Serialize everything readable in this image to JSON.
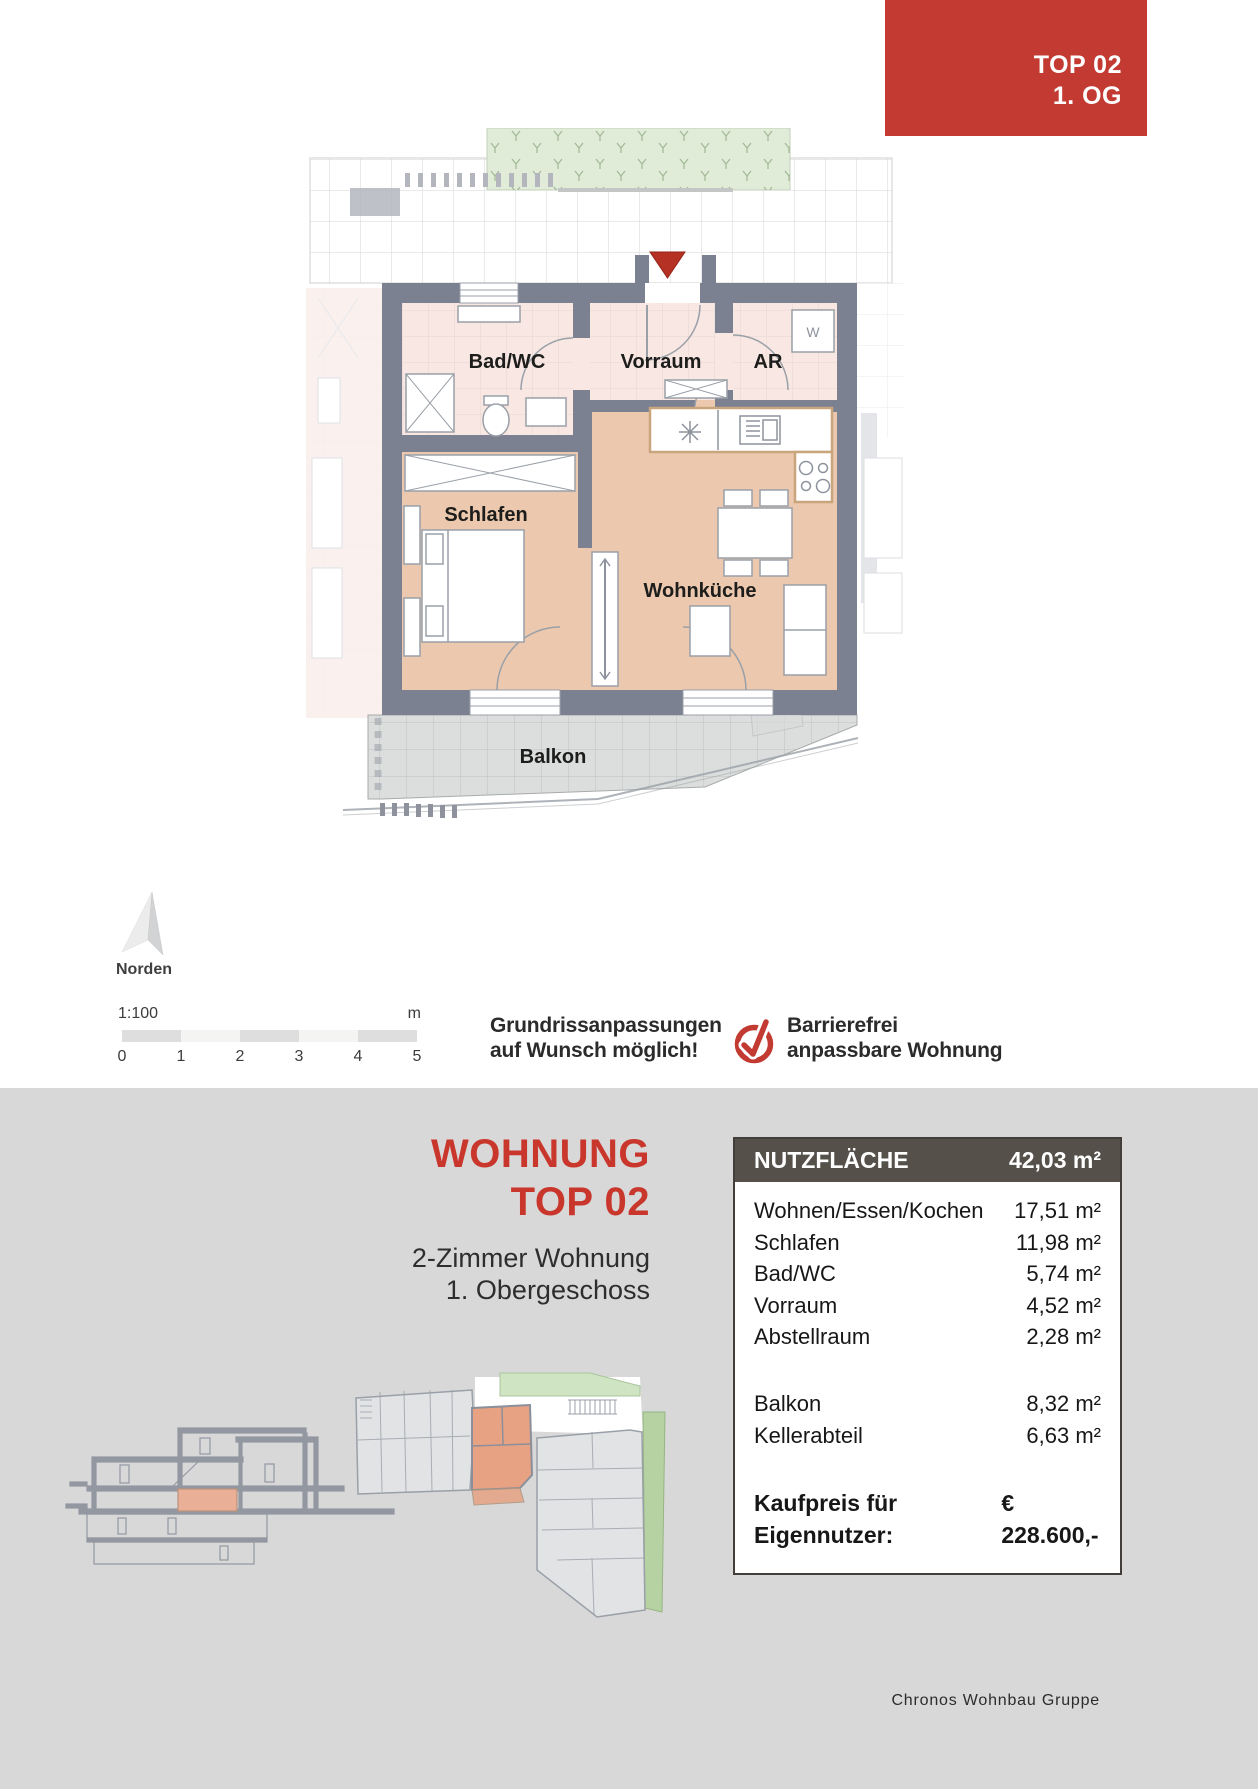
{
  "banner": {
    "line1": "TOP 02",
    "line2": "1. OG"
  },
  "plan": {
    "rooms": {
      "bad": "Bad/WC",
      "vorraum": "Vorraum",
      "ar": "AR",
      "schlafen": "Schlafen",
      "wohnkueche": "Wohnküche",
      "balkon": "Balkon"
    },
    "appliance_w": "W"
  },
  "north": {
    "label": "Norden"
  },
  "scalebar": {
    "ratio": "1:100",
    "unit": "m",
    "ticks": [
      "0",
      "1",
      "2",
      "3",
      "4",
      "5"
    ]
  },
  "note": {
    "line1": "Grundrissanpassungen",
    "line2": "auf Wunsch möglich!"
  },
  "accessibility": {
    "line1": "Barrierefrei",
    "line2": "anpassbare Wohnung"
  },
  "listing": {
    "title_line1": "WOHNUNG",
    "title_line2": "TOP 02",
    "subtitle_line1": "2-Zimmer Wohnung",
    "subtitle_line2": "1. Obergeschoss"
  },
  "table": {
    "header_label": "NUTZFLÄCHE",
    "header_value": "42,03 m²",
    "rows": [
      {
        "label": "Wohnen/Essen/Kochen",
        "value": "17,51 m²"
      },
      {
        "label": "Schlafen",
        "value": "11,98 m²"
      },
      {
        "label": "Bad/WC",
        "value": "5,74 m²"
      },
      {
        "label": "Vorraum",
        "value": "4,52 m²"
      },
      {
        "label": "Abstellraum",
        "value": "2,28 m²"
      }
    ],
    "rows2": [
      {
        "label": "Balkon",
        "value": "8,32 m²"
      },
      {
        "label": "Kellerabteil",
        "value": "6,63 m²"
      }
    ],
    "price_label": "Kaufpreis für Eigennutzer:",
    "price_value": "€ 228.600,-"
  },
  "footer": {
    "company": "Chronos Wohnbau Gruppe"
  },
  "colors": {
    "accent_red": "#c23a31",
    "marker_red": "#b43124",
    "wall_gray": "#7b8190",
    "room_salmon": "#ecc9ae",
    "room_pink": "#f8e7e3",
    "balcony_gray": "#dcdedd",
    "green_area": "#e1ecd8",
    "section_bg": "#d8d8d8",
    "table_header_bg": "#56504b"
  }
}
